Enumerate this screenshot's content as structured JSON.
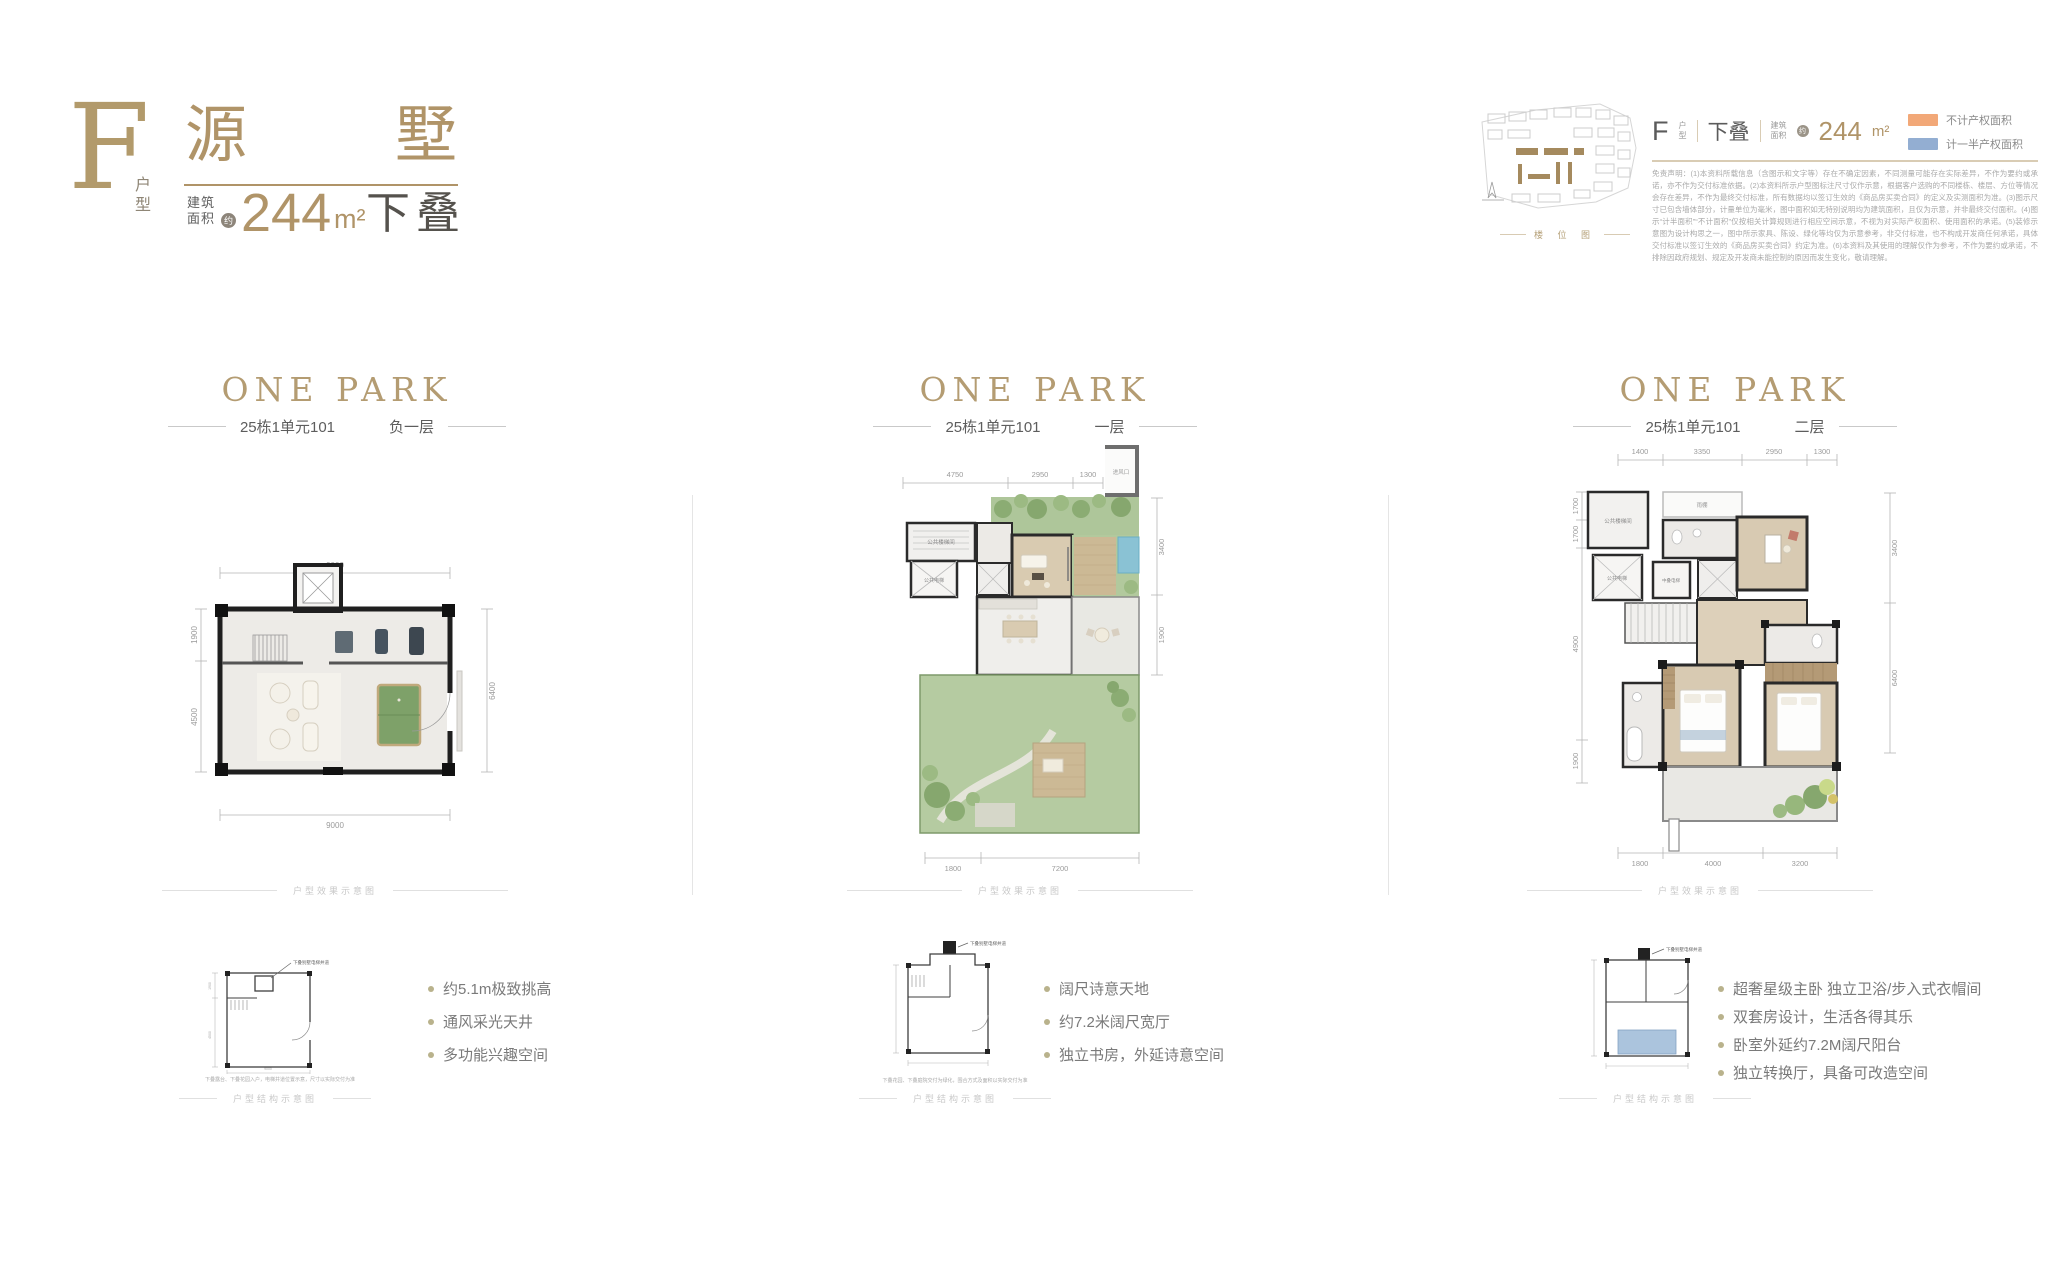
{
  "header_left": {
    "type_letter": "F",
    "type_label": "户型",
    "title_char1": "源",
    "title_char2": "墅",
    "area_label_line1": "建筑",
    "area_label_line2": "面积",
    "area_approx": "约",
    "area_value": "244",
    "area_unit": "m²",
    "stack_label": "下叠"
  },
  "header_right": {
    "unit_letter": "F",
    "unit_label_line1": "户",
    "unit_label_line2": "型",
    "stack_label": "下叠",
    "area_label_line1": "建筑",
    "area_label_line2": "面积",
    "area_approx": "约",
    "area_value": "244",
    "area_unit": "m²",
    "siteplan_caption": "楼 位 图",
    "legend": [
      {
        "label": "不计产权面积",
        "color": "#f2a878"
      },
      {
        "label": "计一半产权面积",
        "color": "#93aed2"
      }
    ],
    "disclaimer": "免责声明：(1)本资料所载信息（含图示和文字等）存在不确定因素，不同测量可能存在实际差异，不作为要约或承诺，亦不作为交付标准依据。(2)本资料所示户型图标注尺寸仅作示意，根据客户选购的不同楼栋、楼层、方位等情况会存在差异，不作为最终交付标准，所有数据均以签订生效的《商品房买卖合同》的定义及实测面积为准。(3)图示尺寸已包含墙体部分，计量单位为毫米，图中面积如无特别说明均为建筑面积，且仅为示意，并非最终交付面积。(4)图示“计半面积”“不计面积”仅按相关计算规则进行相应空间示意，不视为对实际产权面积、使用面积的承诺。(5)装修示意图为设计构思之一，图中所示家具、陈设、绿化等均仅为示意参考，非交付标准，也不构成开发商任何承诺，具体交付标准以签订生效的《商品房买卖合同》约定为准。(6)本资料及其使用的理解仅作为参考，不作为要约或承诺，不排除因政府规划、规定及开发商未能控制的原因而发生变化，敬请理解。"
  },
  "columns": [
    {
      "logo": "ONE PARK",
      "building": "25栋1单元101",
      "floor": "负一层",
      "render_caption": "户型效果示意图",
      "schematic_caption": "户型结构示意图",
      "schematic": {
        "pointer_label": "下叠别墅电梯井道",
        "note": "下叠露台、下叠花园入户，电梯井道位置示意，尺寸以实际交付为准",
        "dims": [
          "1900",
          "4500",
          "9000"
        ]
      },
      "bullets": [
        "约5.1m极致挑高",
        "通风采光天井",
        "多功能兴趣空间"
      ],
      "plan": {
        "top": [
          "9000"
        ],
        "bottom": [
          "9000"
        ],
        "left": [
          "1900",
          "4500"
        ],
        "right": [
          "6400"
        ]
      }
    },
    {
      "logo": "ONE PARK",
      "building": "25栋1单元101",
      "floor": "一层",
      "render_caption": "户型效果示意图",
      "schematic_caption": "户型结构示意图",
      "schematic": {
        "pointer_label": "下叠别墅电梯井道",
        "note": "下叠花园、下叠庭院交付为绿化，围合方式及面积以实际交付为准"
      },
      "bullets": [
        "阔尺诗意天地",
        "约7.2米阔尺宽厅",
        "独立书房，外延诗意空间"
      ],
      "plan": {
        "top": [
          "4750",
          "2950",
          "1300"
        ],
        "right": [
          "3400",
          "1900"
        ],
        "bottom": [
          "1800",
          "7200"
        ],
        "rooms": {
          "air_inlet": "进风口",
          "public_stairs": "公共楼梯间",
          "public_elevator": "公共电梯"
        }
      }
    },
    {
      "logo": "ONE PARK",
      "building": "25栋1单元101",
      "floor": "二层",
      "render_caption": "户型效果示意图",
      "schematic_caption": "户型结构示意图",
      "schematic": {
        "pointer_label": "下叠别墅电梯井道"
      },
      "bullets": [
        "超奢星级主卧 独立卫浴/步入式衣帽间",
        "双套房设计，生活各得其乐",
        "卧室外延约7.2M阔尺阳台",
        "独立转换厅，具备可改造空间"
      ],
      "plan": {
        "top": [
          "1400",
          "3350",
          "2950",
          "1300"
        ],
        "left": [
          "1700",
          "1700",
          "4900",
          "1900"
        ],
        "right": [
          "3400",
          "6400"
        ],
        "bottom": [
          "1800",
          "4000",
          "3200"
        ],
        "rooms": {
          "canopy": "雨棚",
          "public_stairs": "公共楼梯间",
          "public_elevator": "公共电梯",
          "mid_elevator": "中叠电梯"
        }
      }
    }
  ]
}
